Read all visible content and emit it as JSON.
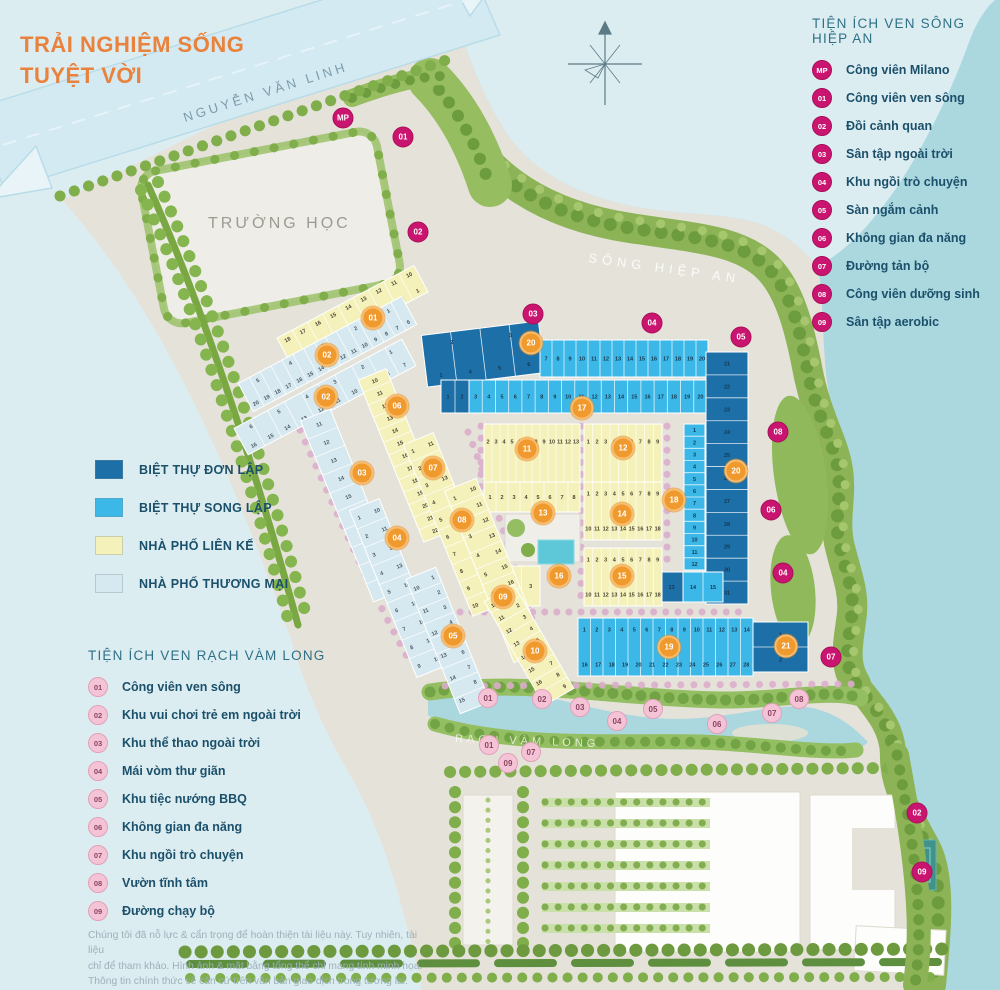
{
  "title": {
    "line1": "TRẢI NGHIỆM SỐNG",
    "line2": "TUYỆT VỜI"
  },
  "map_labels": [
    {
      "id": "road",
      "text": "NGUYỄN VĂN LINH",
      "x": 185,
      "y": 122,
      "angle": -17.5
    },
    {
      "id": "school",
      "text": "TRƯỜNG HỌC",
      "x": 208,
      "y": 228,
      "angle": 0
    },
    {
      "id": "river",
      "text": "SÔNG HIỆP AN",
      "x": 588,
      "y": 262,
      "angle": 8
    },
    {
      "id": "creek",
      "text": "RẠCH VÀM LONG",
      "x": 455,
      "y": 742,
      "angle": 2
    }
  ],
  "legend_river": {
    "title": "TIỆN ÍCH VEN SÔNG HIỆP AN",
    "items": [
      {
        "code": "MP",
        "label": "Công viên Milano"
      },
      {
        "code": "01",
        "label": "Công viên ven sông"
      },
      {
        "code": "02",
        "label": "Đồi cảnh quan"
      },
      {
        "code": "03",
        "label": "Sân tập ngoài trời"
      },
      {
        "code": "04",
        "label": "Khu ngồi trò chuyện"
      },
      {
        "code": "05",
        "label": "Sàn ngắm cảnh"
      },
      {
        "code": "06",
        "label": "Không gian đa năng"
      },
      {
        "code": "07",
        "label": "Đường tản bộ"
      },
      {
        "code": "08",
        "label": "Công viên dưỡng sinh"
      },
      {
        "code": "09",
        "label": "Sân tập aerobic"
      }
    ]
  },
  "legend_housing": {
    "items": [
      {
        "key": "don_lap",
        "label": "BIỆT THỰ ĐƠN LẬP",
        "color": "#1d6fa8"
      },
      {
        "key": "song_lap",
        "label": "BIỆT THỰ SONG LẬP",
        "color": "#3cb8e8"
      },
      {
        "key": "lien_ke",
        "label": "NHÀ PHỐ LIÊN KẾ",
        "color": "#f5f1bb"
      },
      {
        "key": "thuong_mai",
        "label": "NHÀ PHỐ THƯƠNG MẠI",
        "color": "#d7e9f0"
      }
    ]
  },
  "legend_creek": {
    "title": "TIỆN ÍCH VEN RẠCH VÀM LONG",
    "items": [
      {
        "code": "01",
        "label": "Công viên ven sông"
      },
      {
        "code": "02",
        "label": "Khu vui chơi trẻ em ngoài trời"
      },
      {
        "code": "03",
        "label": "Khu thể thao ngoài trời"
      },
      {
        "code": "04",
        "label": "Mái vòm thư giãn"
      },
      {
        "code": "05",
        "label": "Khu tiệc nướng BBQ"
      },
      {
        "code": "06",
        "label": "Không gian đa năng"
      },
      {
        "code": "07",
        "label": "Khu ngồi trò chuyện"
      },
      {
        "code": "08",
        "label": "Vườn tĩnh tâm"
      },
      {
        "code": "09",
        "label": "Đường chạy bộ"
      }
    ]
  },
  "disclaimer": "Chúng tôi đã nỗ lực & cẩn trọng để hoàn thiện tài liệu này. Tuy nhiên, tài liệu\nchỉ để tham khảo. Hình ảnh & mặt bằng tổng thể chỉ mang tính minh họa.\nThông tin chính thức sẽ căn cứ trên văn bản giao dịch trong tương lai.",
  "markers": {
    "block": [
      {
        "n": "01",
        "x": 373,
        "y": 318
      },
      {
        "n": "02",
        "x": 327,
        "y": 355
      },
      {
        "n": "02",
        "x": 326,
        "y": 397
      },
      {
        "n": "03",
        "x": 362,
        "y": 473
      },
      {
        "n": "04",
        "x": 397,
        "y": 538
      },
      {
        "n": "05",
        "x": 453,
        "y": 636
      },
      {
        "n": "06",
        "x": 397,
        "y": 406
      },
      {
        "n": "07",
        "x": 433,
        "y": 468
      },
      {
        "n": "08",
        "x": 462,
        "y": 520
      },
      {
        "n": "09",
        "x": 503,
        "y": 597
      },
      {
        "n": "10",
        "x": 535,
        "y": 651
      },
      {
        "n": "11",
        "x": 527,
        "y": 449
      },
      {
        "n": "12",
        "x": 623,
        "y": 448
      },
      {
        "n": "13",
        "x": 543,
        "y": 513
      },
      {
        "n": "14",
        "x": 622,
        "y": 514
      },
      {
        "n": "15",
        "x": 622,
        "y": 576
      },
      {
        "n": "16",
        "x": 559,
        "y": 576
      },
      {
        "n": "17",
        "x": 582,
        "y": 408
      },
      {
        "n": "18",
        "x": 674,
        "y": 500
      },
      {
        "n": "19",
        "x": 669,
        "y": 647
      },
      {
        "n": "20",
        "x": 531,
        "y": 343
      },
      {
        "n": "20",
        "x": 736,
        "y": 471
      },
      {
        "n": "21",
        "x": 786,
        "y": 646
      }
    ],
    "river": [
      {
        "n": "MP",
        "x": 343,
        "y": 118
      },
      {
        "n": "01",
        "x": 403,
        "y": 137
      },
      {
        "n": "02",
        "x": 418,
        "y": 232
      },
      {
        "n": "03",
        "x": 533,
        "y": 314
      },
      {
        "n": "04",
        "x": 652,
        "y": 323
      },
      {
        "n": "05",
        "x": 741,
        "y": 337
      },
      {
        "n": "08",
        "x": 778,
        "y": 432
      },
      {
        "n": "06",
        "x": 771,
        "y": 510
      },
      {
        "n": "04",
        "x": 783,
        "y": 573
      },
      {
        "n": "07",
        "x": 831,
        "y": 657
      },
      {
        "n": "02",
        "x": 917,
        "y": 813
      },
      {
        "n": "09",
        "x": 922,
        "y": 872
      }
    ],
    "creek": [
      {
        "n": "01",
        "x": 488,
        "y": 698
      },
      {
        "n": "02",
        "x": 542,
        "y": 699
      },
      {
        "n": "03",
        "x": 580,
        "y": 707
      },
      {
        "n": "04",
        "x": 617,
        "y": 721
      },
      {
        "n": "05",
        "x": 653,
        "y": 709
      },
      {
        "n": "06",
        "x": 717,
        "y": 724
      },
      {
        "n": "07",
        "x": 772,
        "y": 713
      },
      {
        "n": "08",
        "x": 799,
        "y": 699
      },
      {
        "n": "01",
        "x": 489,
        "y": 745
      },
      {
        "n": "07",
        "x": 531,
        "y": 752
      },
      {
        "n": "09",
        "x": 508,
        "y": 763
      }
    ]
  },
  "blocks": [
    {
      "id": "20a",
      "type": "don_lap",
      "x": 424,
      "y": 328,
      "w": 118,
      "h": 52,
      "angle": -7,
      "rows": [
        "2 3",
        "1 4 5 6"
      ]
    },
    {
      "id": "20b",
      "type": "song_lap",
      "x": 540,
      "y": 340,
      "w": 168,
      "h": 37,
      "angle": 0,
      "rows": [
        "7 8 9 10 11 12 13 14 15 16 17 18 19 20"
      ]
    },
    {
      "id": "17d",
      "type": "don_lap",
      "x": 441,
      "y": 380,
      "w": 28,
      "h": 33,
      "angle": 0,
      "rows": [
        "1 2"
      ]
    },
    {
      "id": "17",
      "type": "song_lap",
      "x": 469,
      "y": 380,
      "w": 238,
      "h": 33,
      "angle": 0,
      "rows": [
        "3 4 5 6 7 8 9 10 11 12 13 14 15 16 17 18 19 20"
      ]
    },
    {
      "id": "20c",
      "type": "don_lap",
      "x": 706,
      "y": 352,
      "w": 42,
      "h": 252,
      "angle": 0,
      "vertical": true,
      "rows": [
        "21 22 23 24 25 26 27 28 29 30 31"
      ]
    },
    {
      "id": "18a",
      "type": "song_lap",
      "x": 684,
      "y": 424,
      "w": 21,
      "h": 146,
      "angle": 0,
      "vertical": true,
      "rows": [
        "1 2 3 4 5 6 7 8 9 10 11 12"
      ]
    },
    {
      "id": "18b",
      "type": "don_lap",
      "x": 660,
      "y": 572,
      "w": 23,
      "h": 30,
      "angle": 0,
      "rows": [
        "13"
      ]
    },
    {
      "id": "18c",
      "type": "song_lap",
      "x": 683,
      "y": 572,
      "w": 40,
      "h": 30,
      "angle": 0,
      "rows": [
        "14 15"
      ]
    },
    {
      "id": "11",
      "type": "lien_ke",
      "x": 484,
      "y": 424,
      "w": 96,
      "h": 88,
      "angle": 0,
      "rows": [
        "2 3 4 5 6 7 8 9 10 11 12 13",
        "14 15 16 17 18 19 20 21 22 23 24"
      ]
    },
    {
      "id": "12",
      "type": "lien_ke",
      "x": 584,
      "y": 424,
      "w": 78,
      "h": 88,
      "angle": 0,
      "rows": [
        "1 2 3 4 5 6 7 8 9",
        "10 11 12 13 14 15 16 17 18"
      ]
    },
    {
      "id": "13",
      "type": "lien_ke",
      "x": 484,
      "y": 482,
      "w": 96,
      "h": 30,
      "angle": 0,
      "rows": [
        "1 2 3 4 5 6 7 8"
      ]
    },
    {
      "id": "14",
      "type": "lien_ke",
      "x": 584,
      "y": 482,
      "w": 78,
      "h": 58,
      "angle": 0,
      "rows": [
        "1 2 3 4 5 6 7 8 9",
        "10 11 12 13 14 15 16 17 18"
      ]
    },
    {
      "id": "15",
      "type": "lien_ke",
      "x": 584,
      "y": 548,
      "w": 78,
      "h": 58,
      "angle": 0,
      "rows": [
        "1 2 3 4 5 6 7 8 9",
        "10 11 12 13 14 15 16 17 18"
      ]
    },
    {
      "id": "16",
      "type": "lien_ke",
      "x": 484,
      "y": 566,
      "w": 56,
      "h": 40,
      "angle": 0,
      "rows": [
        "1 2 3"
      ]
    },
    {
      "id": "19",
      "type": "song_lap",
      "x": 578,
      "y": 618,
      "w": 175,
      "h": 58,
      "angle": 0,
      "rows": [
        "1 2 3 4 5 6 7 8 9 10 11 12 13 14",
        "15",
        "16 17 18 19 20 21 22 23 24 25 26 27 28"
      ]
    },
    {
      "id": "21",
      "type": "don_lap",
      "x": 753,
      "y": 622,
      "w": 55,
      "h": 50,
      "angle": 0,
      "vertical": true,
      "rows": [
        "1 2"
      ]
    },
    {
      "id": "01s",
      "type": "lien_ke",
      "x": 275,
      "y": 300,
      "w": 155,
      "h": 30,
      "angle": -28,
      "rows": [
        "18 17 16 15 14 13 12 11 10",
        "9 8 7 6 5 4 3 2 1"
      ]
    },
    {
      "id": "02s",
      "type": "thuong_mai",
      "x": 235,
      "y": 338,
      "w": 185,
      "h": 32,
      "angle": -28,
      "rows": [
        "5 4 3 2 1",
        "20 19 18 17 16 15 14 13 12 11 10 9 8 7 6"
      ]
    },
    {
      "id": "02t",
      "type": "thuong_mai",
      "x": 230,
      "y": 382,
      "w": 190,
      "h": 30,
      "angle": -28,
      "rows": [
        "6 5 4 3 2 1",
        "16 15 14 13 12 11 10 9 8 7"
      ]
    },
    {
      "id": "06s",
      "type": "lien_ke",
      "x": 390,
      "y": 368,
      "w": 30,
      "h": 175,
      "angle": -22,
      "vertical": true,
      "rows": [
        "10 11 12 13 14 15 16 17 18 19 20 21 22"
      ]
    },
    {
      "id": "03s",
      "type": "thuong_mai",
      "x": 336,
      "y": 408,
      "w": 32,
      "h": 195,
      "angle": -22,
      "vertical": true,
      "rows": [
        "11 12 13 14 15 16 17 18 19 20"
      ]
    },
    {
      "id": "07s",
      "type": "lien_ke",
      "x": 437,
      "y": 432,
      "w": 32,
      "h": 185,
      "angle": -22,
      "vertical": true,
      "rows": [
        "1 2 3 4 5 6 7 8 9 10",
        "11 12 13 14 15 16 17 18 19 20"
      ]
    },
    {
      "id": "04s",
      "type": "thuong_mai",
      "x": 382,
      "y": 498,
      "w": 32,
      "h": 180,
      "angle": -22,
      "vertical": true,
      "rows": [
        "1 2 3 4 5 6 7 8 9",
        "10 11 12 13 14 15 16 17 18"
      ]
    },
    {
      "id": "08s",
      "type": "lien_ke",
      "x": 478,
      "y": 478,
      "w": 34,
      "h": 185,
      "angle": -22,
      "vertical": true,
      "rows": [
        "1 2 3 4 5 6 7 8 9",
        "10 11 12 13 14 15 16 17 18 19 20"
      ]
    },
    {
      "id": "05s",
      "type": "thuong_mai",
      "x": 432,
      "y": 568,
      "w": 32,
      "h": 145,
      "angle": -22,
      "vertical": true,
      "rows": [
        "10 11 12 13 14 15",
        "1 2 3 4 5 6 7 8 9"
      ]
    },
    {
      "id": "10s",
      "type": "lien_ke",
      "x": 512,
      "y": 585,
      "w": 34,
      "h": 120,
      "angle": -30,
      "vertical": true,
      "rows": [
        "10 11 12 13 14 15 16 17",
        "1 2 3 4 5 6 7 8 9"
      ]
    }
  ]
}
